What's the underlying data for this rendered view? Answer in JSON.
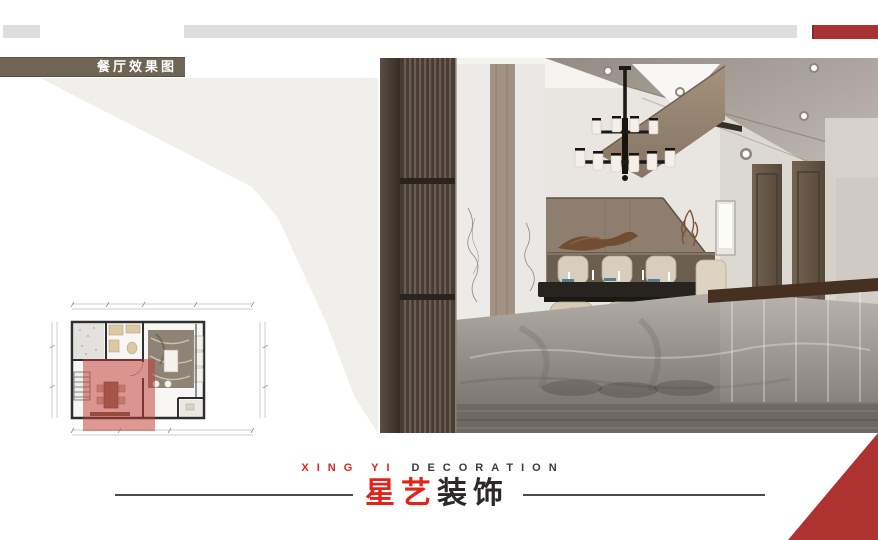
{
  "badge": {
    "label": "餐厅效果图"
  },
  "top_bars": {
    "left_color": "#dedede",
    "center_color": "#dedede",
    "accent_color": "#a93331"
  },
  "photo": {
    "description": "dining-room-interior-rendering"
  },
  "floor_plan": {
    "highlight_color": "#c0392b",
    "highlight_opacity": 0.5
  },
  "footer": {
    "tagline_red": "XING YI",
    "tagline_dark": "DECORATION",
    "brand_red": "星艺",
    "brand_dark": "装饰"
  },
  "colors": {
    "brand_red": "#e2231a",
    "accent_red": "#ae3330",
    "badge_bg": "#6e6555",
    "panel_gray": "#f1efec"
  }
}
